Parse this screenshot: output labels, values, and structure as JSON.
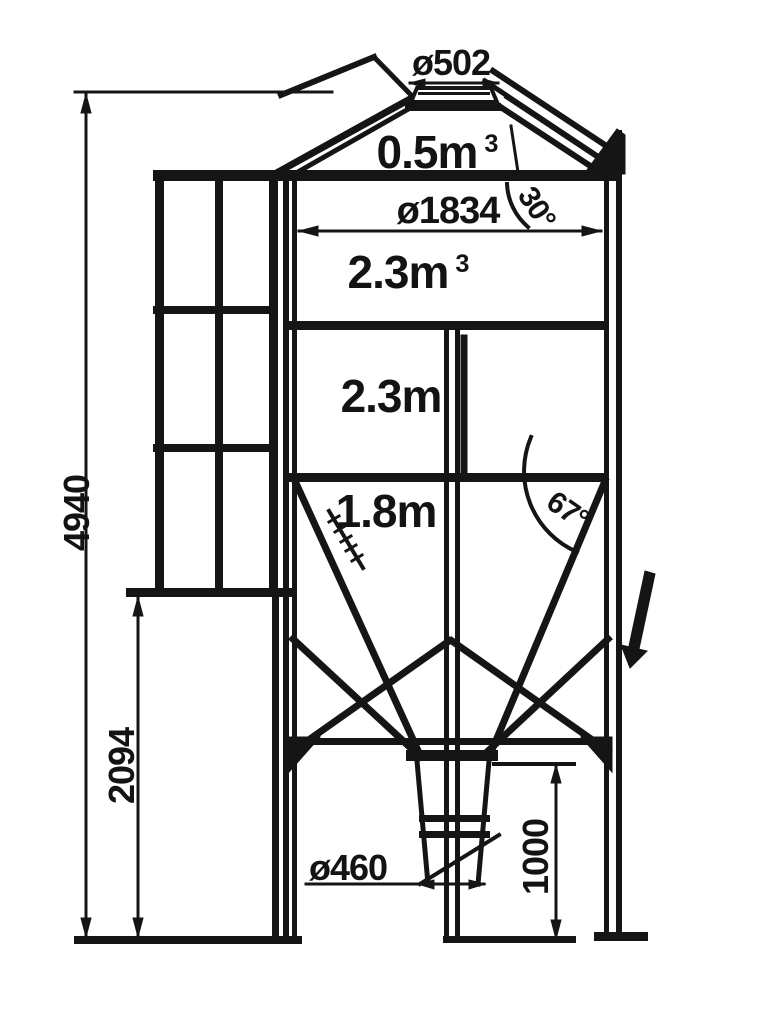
{
  "drawing": {
    "colors": {
      "line": "#151515",
      "background": "#ffffff"
    },
    "annotations": {
      "top_diameter": {
        "text": "ø502"
      },
      "top_volume": {
        "text": "0.5m",
        "sup": "3"
      },
      "body_diameter": {
        "text": "ø1834"
      },
      "roof_angle": {
        "text": "30°"
      },
      "mid_volume": {
        "text": "2.3m",
        "sup": "3"
      },
      "mid_height": {
        "text": "2.3m"
      },
      "lower_height": {
        "text": "1.8m"
      },
      "hopper_angle": {
        "text": "67°"
      },
      "total_height": {
        "text": "4940"
      },
      "leg_height": {
        "text": "2094"
      },
      "outlet_diameter": {
        "text": "ø460"
      },
      "outlet_height": {
        "text": "1000"
      }
    }
  }
}
